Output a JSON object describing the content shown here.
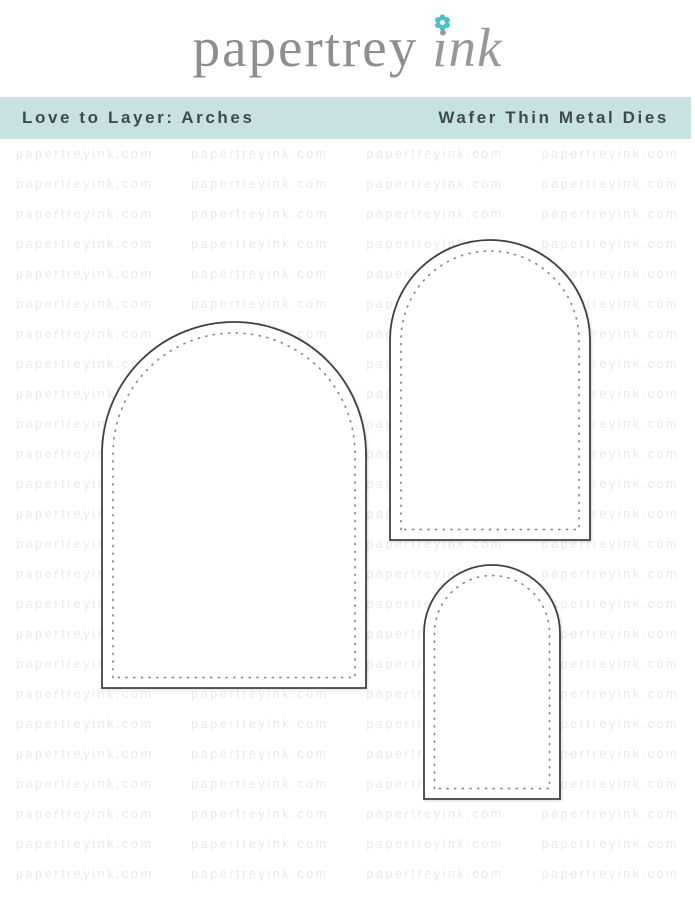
{
  "logo": {
    "brand_serif": "papertrey",
    "brand_script": "ink"
  },
  "banner": {
    "left_label": "Love to Layer: Arches",
    "right_label": "Wafer Thin Metal Dies"
  },
  "watermark": {
    "text": "papertreyink.com",
    "rows": 25,
    "columns": 4
  },
  "dies": {
    "count": 3,
    "names": [
      "large-arch",
      "medium-arch",
      "small-arch"
    ]
  },
  "colors": {
    "banner_bg": "#c7e2e1",
    "banner_text": "#3f4b4b",
    "logo_gray": "#8d8e90",
    "flower_teal": "#4bbfc4",
    "watermark": "#e9e9e9",
    "die_outline": "#404040",
    "stitch_dots": "#8c8c8c"
  }
}
